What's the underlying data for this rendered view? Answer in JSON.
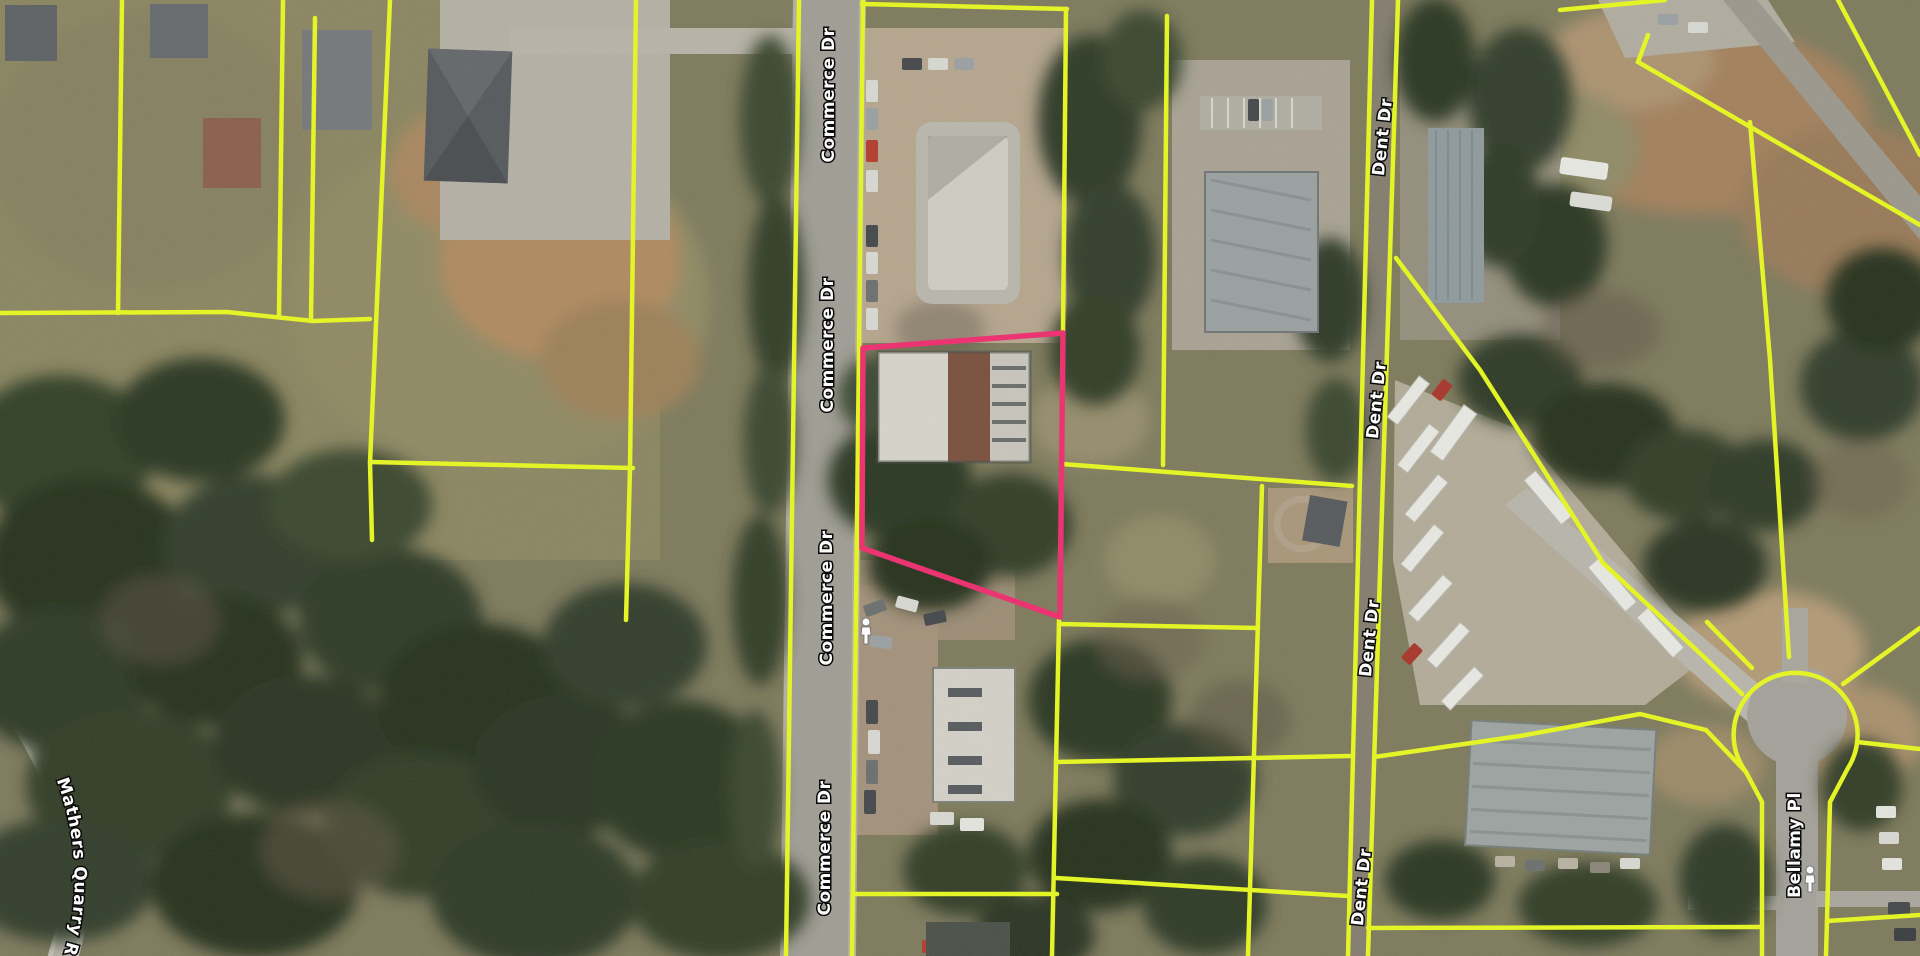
{
  "map": {
    "roads": {
      "commerce": {
        "label": "Commerce Dr"
      },
      "dent": {
        "label": "Dent Dr"
      },
      "mathers": {
        "label": "Mathers Quarry Rd"
      },
      "bellamy": {
        "label": "Bellamy Pl"
      }
    },
    "colors": {
      "parcel_line": "#e6f71f",
      "highlight_parcel": "#ee2d6e",
      "road_label_fill": "#ffffff",
      "road_label_outline": "#000000"
    },
    "icons": {
      "pegman": "street-view pegman"
    }
  }
}
